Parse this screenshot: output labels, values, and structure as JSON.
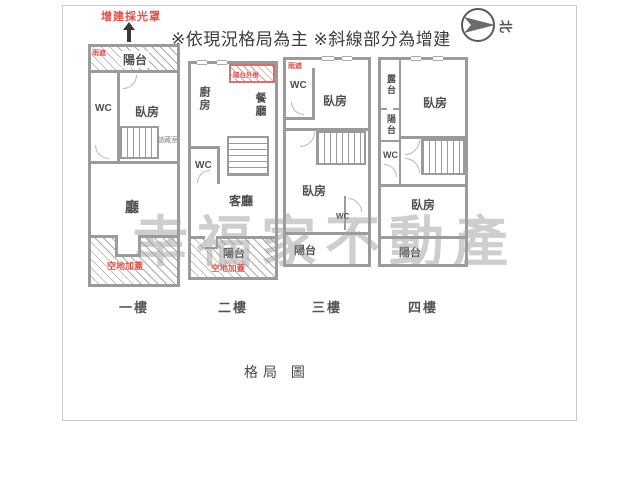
{
  "annotations": {
    "skylight_note": "增建採光罩",
    "disclaimer": "※依現況格局為主 ※斜線部分為增建",
    "compass": "北",
    "watermark": "幸福家不動產",
    "caption": "格局 圖"
  },
  "colors": {
    "wall": "#9b9b9b",
    "annotation_red": "#e0514c",
    "label_text": "#4f4f4f",
    "watermark_gray": "#9e9e9e"
  },
  "floors": [
    {
      "label": "一樓",
      "rooms": {
        "canopy": "雨遮",
        "balcony": "陽台",
        "wc": "WC",
        "bedroom": "臥房",
        "storage": "儲藏室",
        "hall": "廳",
        "addition": "空地加蓋"
      }
    },
    {
      "label": "二樓",
      "rooms": {
        "pushout": "陽台外推",
        "kitchen": "廚房",
        "dining": "餐廳",
        "wc": "WC",
        "living": "客廳",
        "balcony": "陽台",
        "addition": "空地加蓋"
      }
    },
    {
      "label": "三樓",
      "rooms": {
        "canopy": "雨遮",
        "wc_top": "WC",
        "bedroom_top": "臥房",
        "bedroom_bottom": "臥房",
        "wc_bottom": "WC",
        "balcony": "陽台"
      }
    },
    {
      "label": "四樓",
      "rooms": {
        "terrace": "露台",
        "balcony_side": "陽台",
        "wc": "WC",
        "bedroom_top": "臥房",
        "bedroom_bottom": "臥房",
        "balcony": "陽台"
      }
    }
  ]
}
